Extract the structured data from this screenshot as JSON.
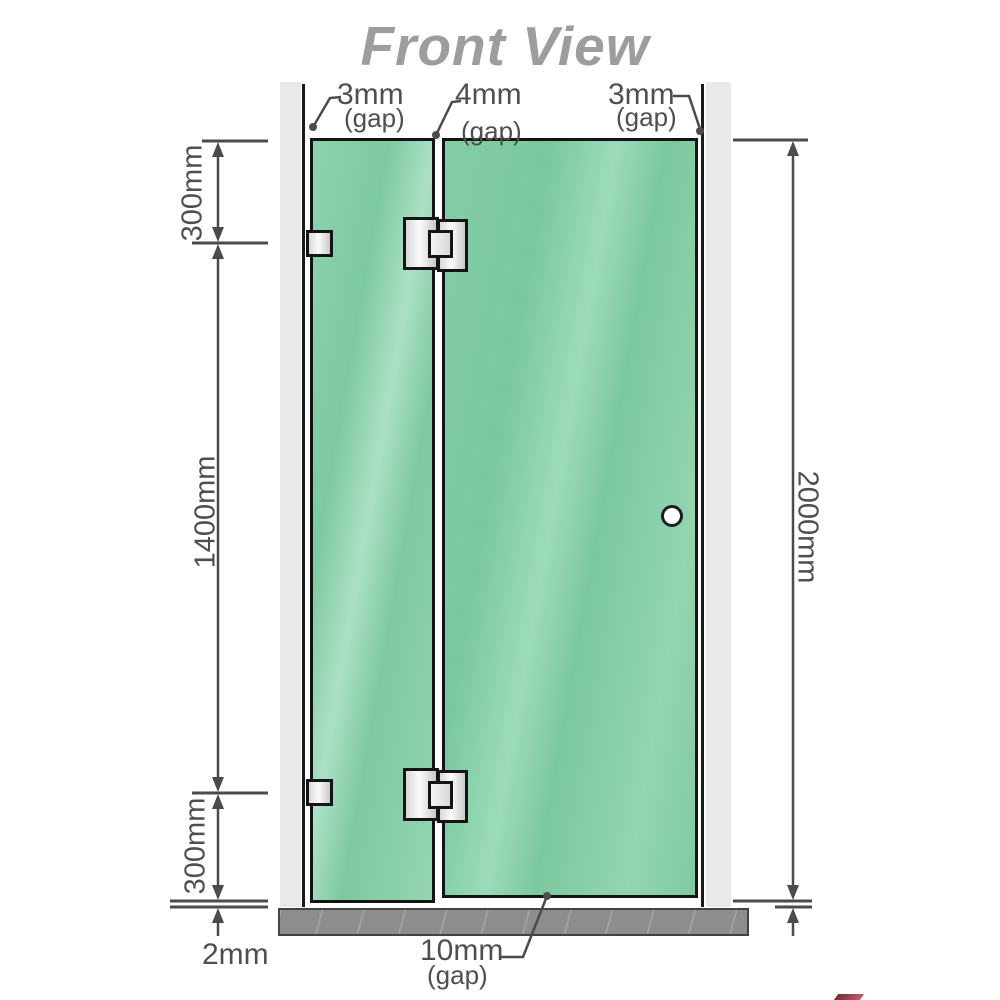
{
  "title": "Front View",
  "labels": {
    "gap_top_left": {
      "value": "3mm",
      "note": "(gap)"
    },
    "gap_top_middle": {
      "value": "4mm",
      "note": "(gap)"
    },
    "gap_top_right": {
      "value": "3mm",
      "note": "(gap)"
    },
    "segment_top": "300mm",
    "segment_middle": "1400mm",
    "segment_bottom": "300mm",
    "floor_clearance": "2mm",
    "door_floor_gap": {
      "value": "10mm",
      "note": "(gap)"
    },
    "total_height": "2000mm"
  },
  "colors": {
    "glass": "#7cc9a1",
    "glass_highlight": "#abe0c5",
    "wall": "#e9e9e9",
    "floor": "#8d8d8d",
    "dimension_line": "#4b4b4b",
    "title_text": "#9d9d9d",
    "hardware_fill": "#f2f2f2",
    "outline": "#141414",
    "watermark": "#5a0d18"
  }
}
